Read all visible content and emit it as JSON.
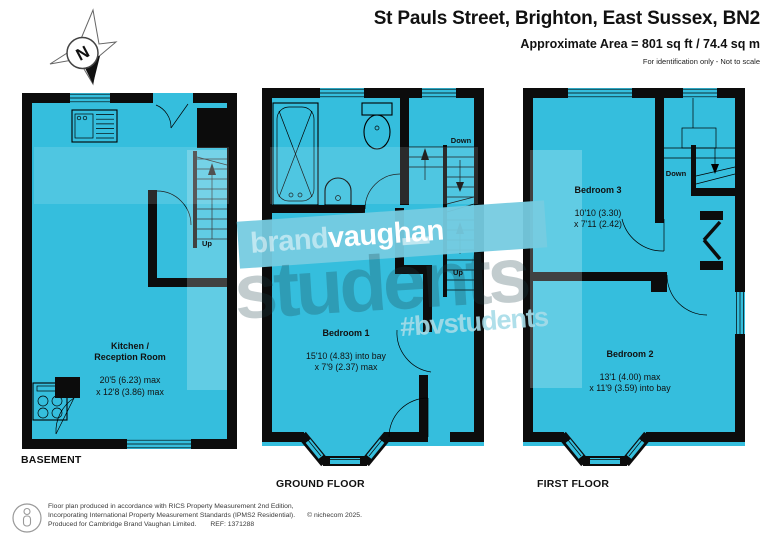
{
  "header": {
    "title": "St Pauls Street, Brighton, East Sussex, BN2",
    "area": "Approximate Area = 801 sq ft / 74.4 sq m",
    "disclaimer": "For identification only - Not to scale",
    "compass": "N"
  },
  "watermark": {
    "brand_light": "brand",
    "brand_bold": "vaughan",
    "big_text": "students",
    "hashtag": "#bvstudents"
  },
  "floors": {
    "basement": {
      "label": "BASEMENT",
      "room": {
        "name": "Kitchen /\nReception Room",
        "dims": "20'5 (6.23) max\nx 12'8 (3.86) max"
      },
      "stair_up": "Up"
    },
    "ground": {
      "label": "GROUND FLOOR",
      "room": {
        "name": "Bedroom 1",
        "dims": "15'10 (4.83) into bay\nx 7'9 (2.37) max"
      },
      "stair_down": "Down",
      "stair_up": "Up"
    },
    "first": {
      "label": "FIRST FLOOR",
      "room3": {
        "name": "Bedroom 3",
        "dims": "10'10 (3.30)\nx 7'11 (2.42)"
      },
      "room2": {
        "name": "Bedroom 2",
        "dims": "13'1 (4.00) max\nx 11'9 (3.59) into bay"
      },
      "stair_down": "Down"
    }
  },
  "footer": {
    "line1": "Floor plan produced in accordance with RICS Property Measurement 2nd Edition,",
    "line2": "Incorporating International Property Measurement Standards (IPMS2 Residential).",
    "line3": "Produced for Cambridge Brand Vaughan Limited.",
    "ref": "REF:  1371288",
    "copyright": "© nichecom 2025."
  },
  "colors": {
    "plan_fill": "#35bedd",
    "wall": "#0c0c0c",
    "banner": "rgba(118,203,224,0.95)",
    "watermark_text": "rgba(30,65,75,0.27)",
    "hashtag_text": "rgba(166,219,232,0.9)"
  }
}
